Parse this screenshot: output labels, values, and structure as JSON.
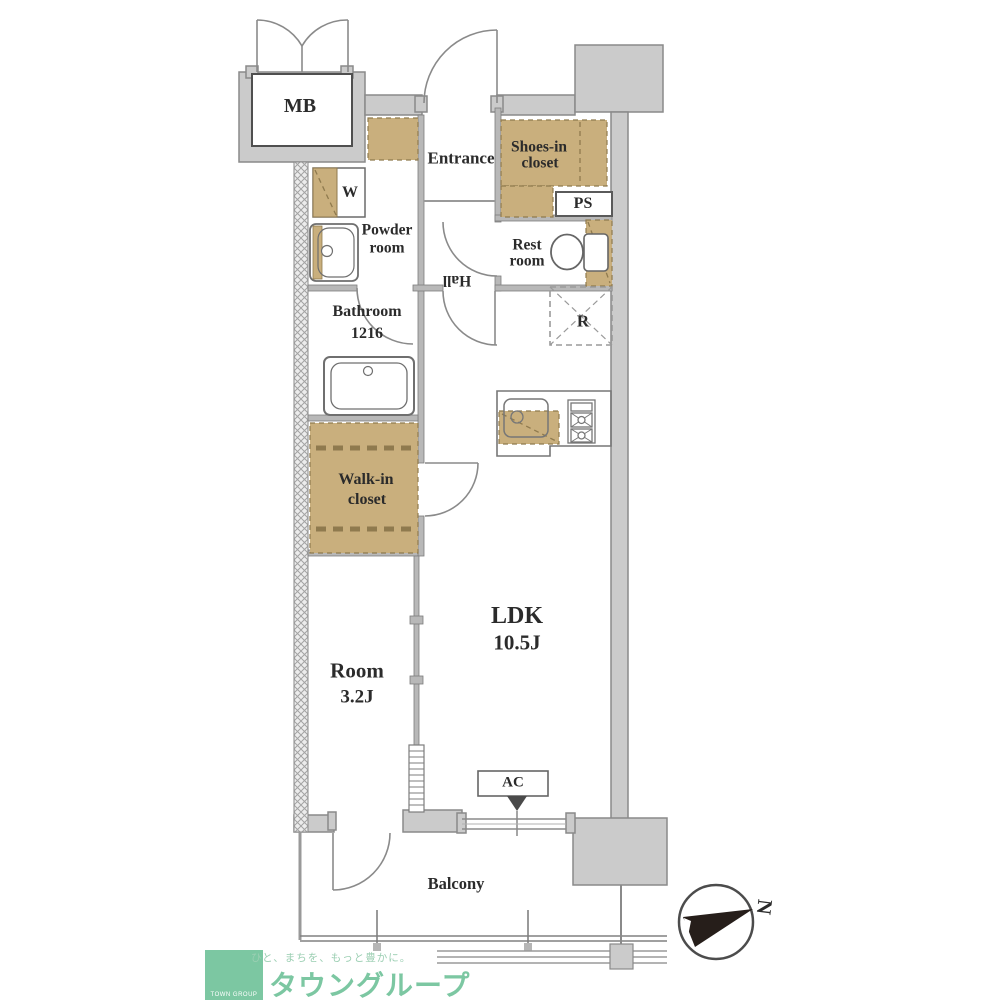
{
  "colors": {
    "wall_fill": "#cbcbcb",
    "wall_stroke": "#8a8a8a",
    "closet_tan": "#c9af7d",
    "tan_dash": "#8f7a4e",
    "logo_green": "#7cc7a2",
    "label_text": "#2b2b2b"
  },
  "labels": {
    "mb": "MB",
    "entrance": "Entrance",
    "shoes_line1": "Shoes-in",
    "shoes_line2": "closet",
    "ps": "PS",
    "rest_line1": "Rest",
    "rest_line2": "room",
    "washer": "W",
    "powder_line1": "Powder",
    "powder_line2": "room",
    "hall": "Hall",
    "bathroom": "Bathroom",
    "bathroom_size": "1216",
    "fridge": "R",
    "wic_line1": "Walk-in",
    "wic_line2": "closet",
    "ldk": "LDK",
    "ldk_size": "10.5J",
    "room": "Room",
    "room_size": "3.2J",
    "ac": "AC",
    "balcony": "Balcony"
  },
  "compass": {
    "north": "N"
  },
  "logo": {
    "slogan": "ひと、まちを、もっと豊かに。",
    "brand": "タウングループ",
    "badge": "TOWN GROUP"
  }
}
